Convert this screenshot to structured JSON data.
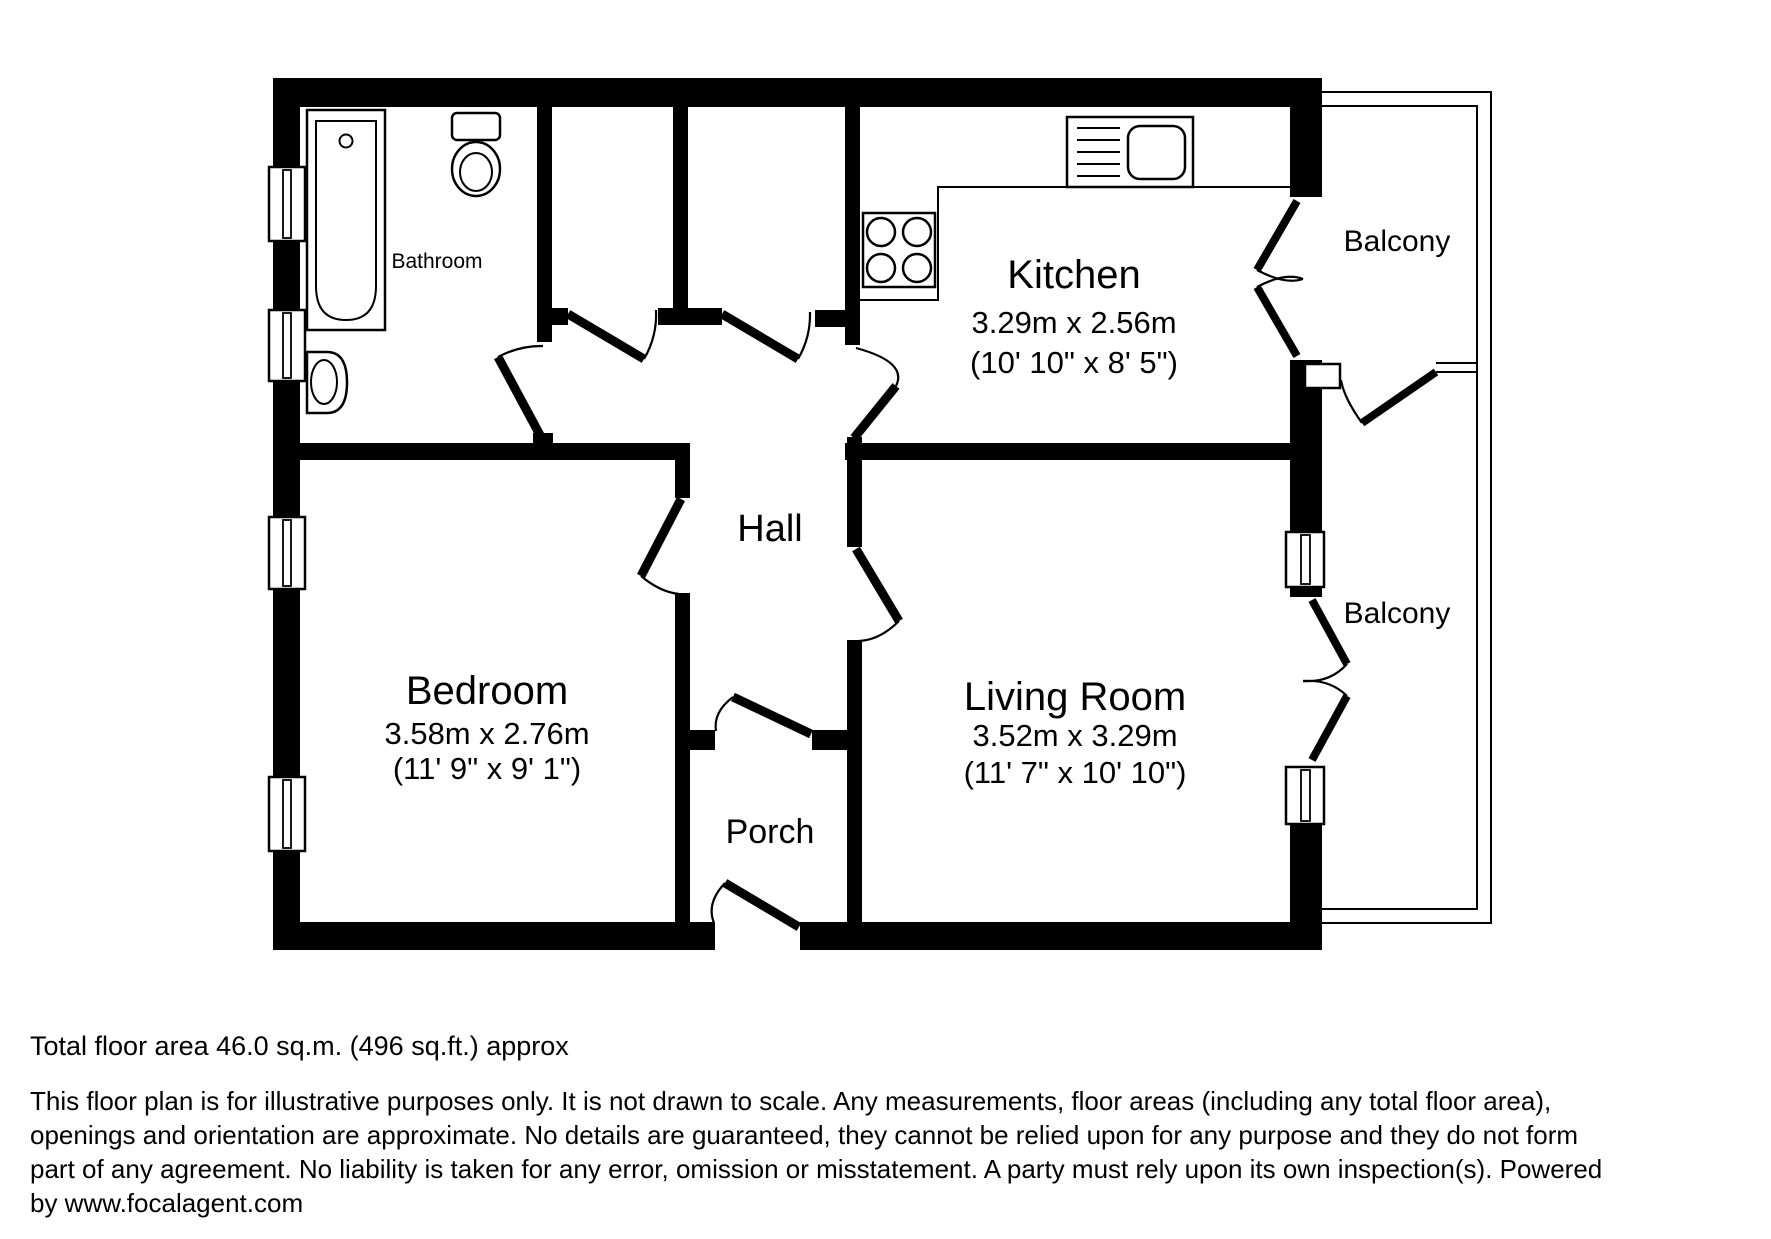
{
  "plan": {
    "type": "residential floor plan",
    "colors": {
      "wall": "#000000",
      "background": "#ffffff",
      "text": "#000000"
    },
    "rooms": {
      "bathroom": {
        "name": "Bathroom"
      },
      "kitchen": {
        "name": "Kitchen",
        "metric": "3.29m x 2.56m",
        "imperial": "(10' 10\" x 8' 5\")"
      },
      "hall": {
        "name": "Hall"
      },
      "bedroom": {
        "name": "Bedroom",
        "metric": "3.58m x 2.76m",
        "imperial": "(11' 9\" x 9' 1\")"
      },
      "living_room": {
        "name": "Living Room",
        "metric": "3.52m x 3.29m",
        "imperial": "(11' 7\" x 10' 10\")"
      },
      "porch": {
        "name": "Porch"
      },
      "balcony_top": {
        "name": "Balcony"
      },
      "balcony_middle": {
        "name": "Balcony"
      }
    },
    "fixture_icons": [
      "bathtub-icon",
      "toilet-icon",
      "basin-icon",
      "hob-icon",
      "kitchen-sink-icon",
      "window-icon",
      "door-swing-icon"
    ]
  },
  "footer": {
    "total_area": "Total floor area 46.0 sq.m. (496 sq.ft.) approx",
    "disclaimer_lines": [
      "This floor plan is for illustrative purposes only. It is not drawn to scale. Any measurements, floor areas (including any total floor area),",
      "openings and orientation are approximate. No details are guaranteed, they cannot be relied upon for any purpose and they do not form",
      "part of any agreement. No liability is taken for any error, omission or misstatement. A party must rely upon its own inspection(s). Powered",
      "by www.focalagent.com"
    ]
  }
}
